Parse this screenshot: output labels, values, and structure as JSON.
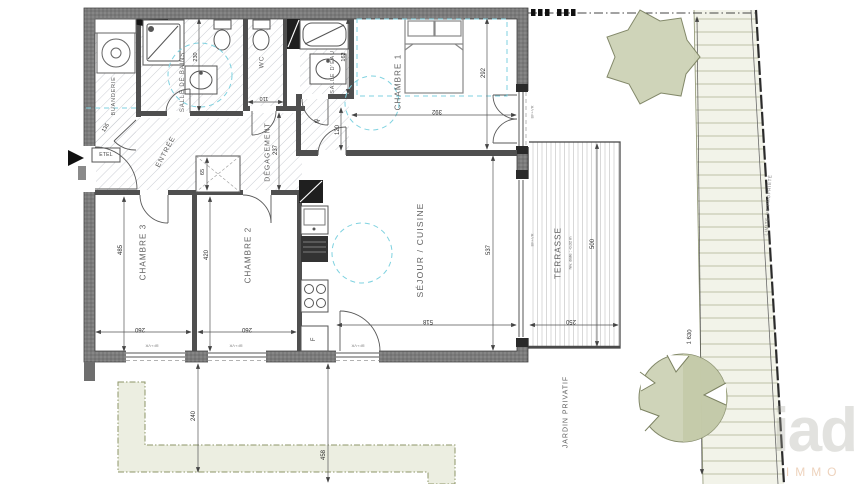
{
  "rooms": {
    "buanderie": "BUANDERIE",
    "salle_de_bains": "SALLE DE BAINS",
    "wc": "WC",
    "salle_deau": "SALLE D'EAU",
    "chambre1": "CHAMBRE 1",
    "entree": "ENTRÉE",
    "degagement": "DÉGAGEMENT",
    "chambre3": "CHAMBRE 3",
    "chambre2": "CHAMBRE 2",
    "sejour": "SÉJOUR / CUISINE",
    "terrasse": "TERRASSE",
    "terrasse_note": "Niv. dalle : -0,02 m",
    "jardin": "JARDIN PRIVATIF"
  },
  "annotations": {
    "property_line": "LIMITE DE PROPRIÉTÉ",
    "etel": "ETEL",
    "fridge": "F",
    "window_tag": "BF+VR"
  },
  "dimensions": {
    "chambre3_h": "485",
    "chambre3_w": "260",
    "chambre2_h": "420",
    "chambre2_w": "260",
    "chambre1_w": "392",
    "chambre1_h": "292",
    "sejour_h": "537",
    "sejour_w": "518",
    "terrasse_h": "500",
    "terrasse_w": "250",
    "degagement_h": "237",
    "door_ch1": "120",
    "wc_w": "110",
    "entree_small": "45",
    "buanderie": "135",
    "salle_deau_w": "162",
    "sdb_h": "230",
    "placard": "65",
    "garden_near": "240",
    "garden_far": "458",
    "garden_length": "1 630"
  },
  "watermark": {
    "brand": "iad",
    "sub": "IMMO"
  },
  "colors": {
    "wall_gray": "#7b7b7b",
    "accessibility_cyan": "#7fd2e0",
    "vegetation_green": "#cdd2b6",
    "hedge_fill": "#f2f3e9",
    "path_fill": "#eceee1"
  }
}
